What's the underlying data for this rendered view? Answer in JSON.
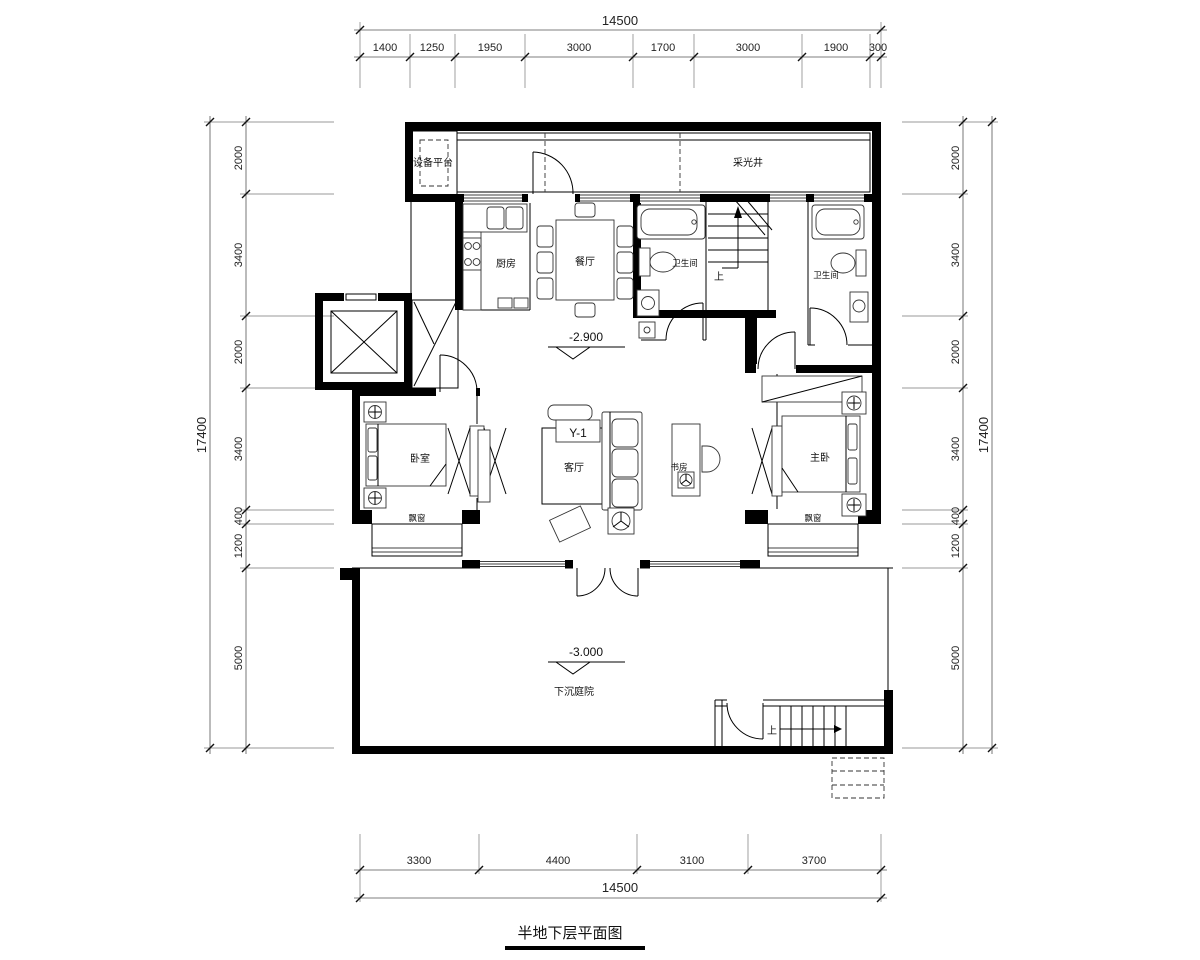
{
  "drawing": {
    "caption": "半地下层平面图"
  },
  "dimensions": {
    "top": {
      "total": "14500",
      "segments": [
        "1400",
        "1250",
        "1950",
        "3000",
        "1700",
        "3000",
        "1900",
        "300"
      ]
    },
    "bottom": {
      "total": "14500",
      "segments": [
        "3300",
        "4400",
        "3100",
        "3700"
      ]
    },
    "left": {
      "total": "17400",
      "segments": [
        "2000",
        "3400",
        "2000",
        "3400",
        "400",
        "1200",
        "5000"
      ]
    },
    "right": {
      "total": "17400",
      "segments": [
        "2000",
        "3400",
        "2000",
        "3400",
        "400",
        "1200",
        "5000"
      ]
    }
  },
  "rooms": {
    "equipment_platform": "设备平台",
    "light_well": "采光井",
    "kitchen": "厨房",
    "dining_room": "餐厅",
    "bathroom_1": "卫生间",
    "bathroom_2": "卫生间",
    "bedroom": "卧室",
    "living_room": "客厅",
    "study": "书房",
    "master_bedroom": "主卧",
    "bay_window_left": "飘窗",
    "bay_window_right": "飘窗",
    "sunken_courtyard": "下沉庭院"
  },
  "annotations": {
    "level_main": "-2.900",
    "level_courtyard": "-3.000",
    "stairs_up_interior": "上",
    "stairs_up_exterior": "上",
    "beam_tag": "Y-1"
  }
}
